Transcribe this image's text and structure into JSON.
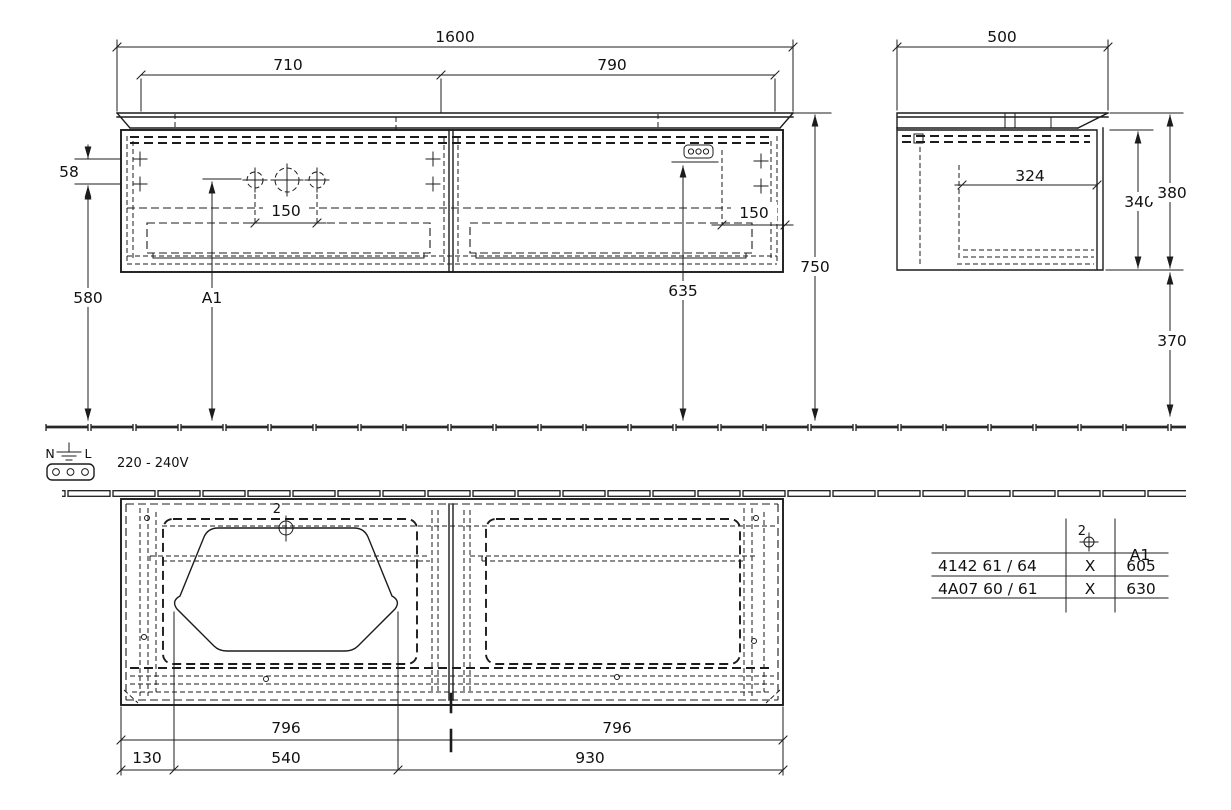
{
  "front_view": {
    "dims": {
      "overall_width": "1600",
      "left_section": "710",
      "right_section": "790",
      "side_inset": "58",
      "height_to_holes": "580",
      "hole_spacing_left": "150",
      "hole_spacing_right": "150",
      "socket_height": "635",
      "overall_height": "750",
      "hole_label": "A1"
    }
  },
  "side_view": {
    "dims": {
      "depth": "500",
      "inner_depth": "324",
      "body_height": "340",
      "total_height": "380",
      "floor_clearance": "370"
    }
  },
  "plan_view": {
    "dims": {
      "left_width": "796",
      "right_width": "796",
      "edge_offset": "130",
      "basin_span": "540",
      "right_span": "930"
    },
    "drain_label": "2"
  },
  "electrical": {
    "neutral": "N",
    "line": "L",
    "voltage": "220 - 240V"
  },
  "spec_table": {
    "symbol_header": "2",
    "a1_header": "A1",
    "rows": [
      {
        "model": "4142 61 / 64",
        "symbol_value": "X",
        "a1_value": "605"
      },
      {
        "model": "4A07 60 / 61",
        "symbol_value": "X",
        "a1_value": "630"
      }
    ]
  }
}
